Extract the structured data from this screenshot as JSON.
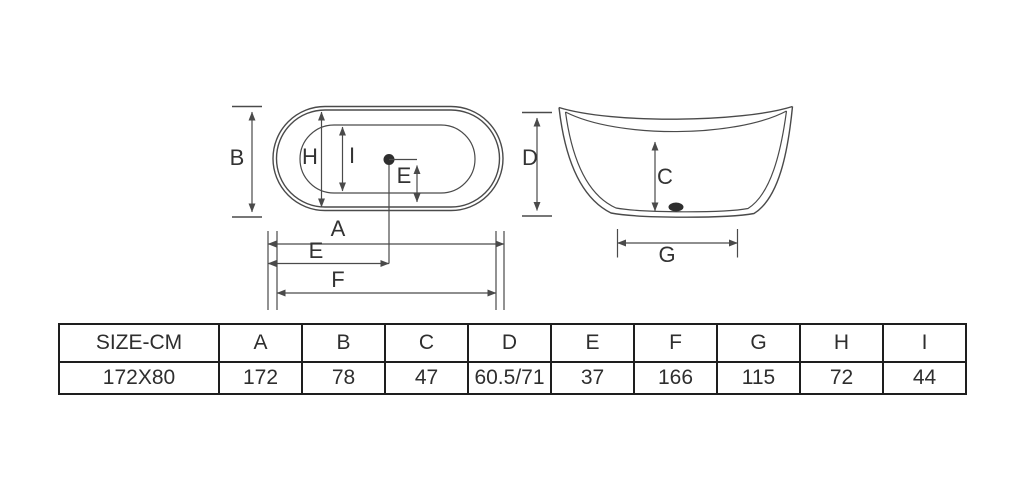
{
  "colors": {
    "line": "#4a4a4a",
    "text": "#333333",
    "table_border": "#1e1e1e"
  },
  "diagram": {
    "top_view": {
      "label_b": "B",
      "label_h": "H",
      "label_i": "I",
      "label_e_drain": "E",
      "label_a": "A",
      "label_e": "E",
      "label_f": "F"
    },
    "side_view": {
      "label_d": "D",
      "label_c": "C",
      "label_g": "G"
    }
  },
  "table": {
    "headers": [
      "SIZE-CM",
      "A",
      "B",
      "C",
      "D",
      "E",
      "F",
      "G",
      "H",
      "I"
    ],
    "rows": [
      [
        "172X80",
        "172",
        "78",
        "47",
        "60.5/71",
        "37",
        "166",
        "115",
        "72",
        "44"
      ]
    ]
  }
}
